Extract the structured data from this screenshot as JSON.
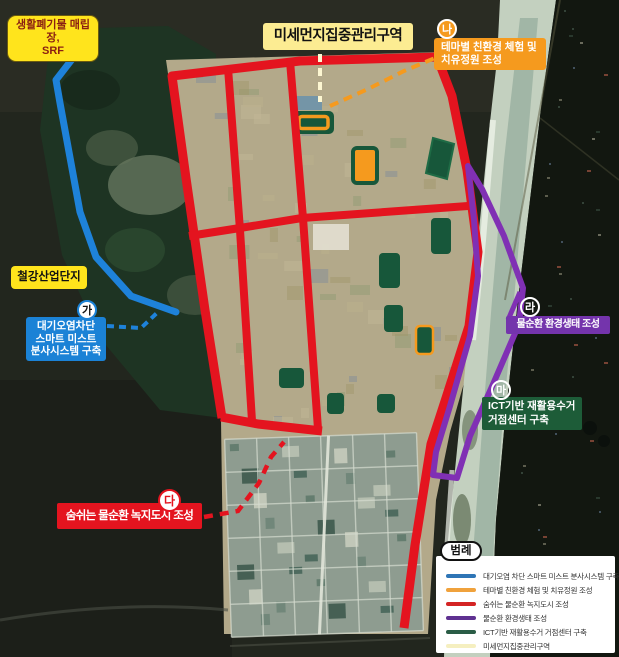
{
  "annotations": {
    "landfill": {
      "lines": [
        "생활폐기물 매립장,",
        "SRF"
      ]
    },
    "zone_title": {
      "text": "미세먼지집중관리구역"
    },
    "steel": {
      "text": "철강산업단지"
    },
    "ga": {
      "badge": "가",
      "color": "#1b82d6",
      "lines": [
        "대기오염차단",
        "스마트 미스트",
        "분사시스템 구축"
      ]
    },
    "na": {
      "badge": "나",
      "color": "#f59a1e",
      "lines": [
        "테마별 친환경 체험 및",
        "치유정원 조성"
      ]
    },
    "da": {
      "badge": "다",
      "color": "#e4141f",
      "lines": [
        "숨쉬는 물순환 녹지도시 조성"
      ]
    },
    "ra": {
      "badge": "라",
      "color": "#7434ac",
      "lines": [
        "물순환 환경생태 조성"
      ]
    },
    "ma": {
      "badge": "마",
      "color": "#1d5c38",
      "lines": [
        "ICT기반 재활용수거",
        "거점센터 구축"
      ]
    }
  },
  "legend": {
    "title": "범례",
    "items": [
      {
        "color": "#2e75b6",
        "label": "대기오염 차단 스마트 미스트 분사시스템 구축"
      },
      {
        "color": "#f0a23c",
        "label": "테마별 친환경 체험 및 치유정원 조성"
      },
      {
        "color": "#d42424",
        "label": "숨쉬는 물순환 녹지도시 조성"
      },
      {
        "color": "#5f3191",
        "label": "물순환 환경생태 조성"
      },
      {
        "color": "#2a5c46",
        "label": "ICT기반 재활용수거 거점센터 구축"
      },
      {
        "color": "#f5efc0",
        "label": "미세먼지집중관리구역"
      }
    ]
  },
  "map_colors": {
    "zone_boundary_red": "#e4141f",
    "mist_line_blue": "#1e82da",
    "garden_orange": "#f59a1e",
    "water_purple": "#8030b4",
    "site_green": "#17573a",
    "label_yellow": "#ffe41c",
    "title_yellow": "#fcec92"
  }
}
